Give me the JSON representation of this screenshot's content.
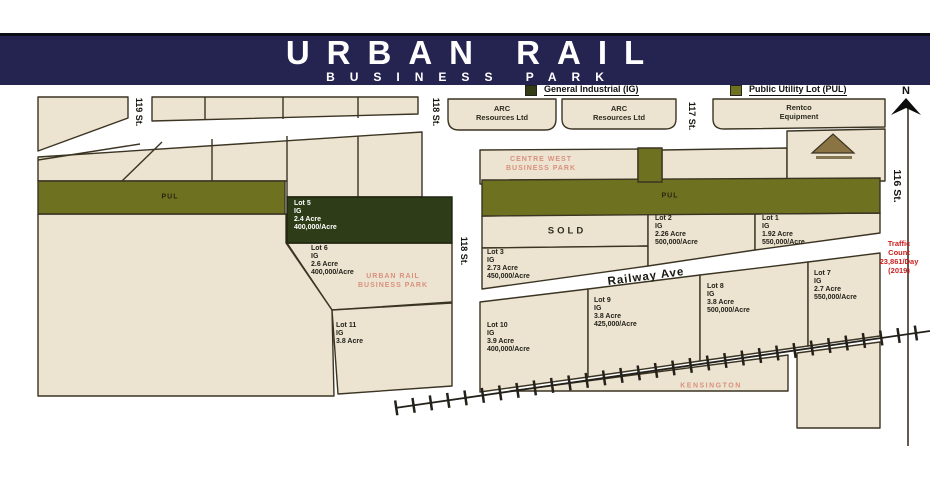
{
  "header": {
    "title": "URBAN RAIL",
    "subtitle": "BUSINESS PARK"
  },
  "legend": {
    "general": {
      "label": "General Industrial (IG)",
      "color": "#323d14"
    },
    "pul": {
      "label": "Public Utility Lot (PUL)",
      "color": "#6e7120"
    }
  },
  "compass": {
    "label": "N"
  },
  "streets": {
    "s119": "119 St.",
    "s118_top": "118 St.",
    "s118_mid": "118 St.",
    "s117": "117 St.",
    "s116": "116 St.",
    "railway": "Railway Ave"
  },
  "labels": {
    "pul_left": "PUL",
    "pul_right": "PUL",
    "sold": "SOLD",
    "centre_west": "CENTRE WEST\nBUSINESS PARK",
    "urban_rail_park": "URBAN RAIL\nBUSINESS PARK",
    "kensington": "KENSINGTON",
    "traffic": "Traffic\nCount\n23,861/Day\n(2019)"
  },
  "businesses": {
    "arc1": "ARC\nResources Ltd",
    "arc2": "ARC\nResources Ltd",
    "rentco": "Rentco\nEquipment"
  },
  "lots": {
    "lot1": {
      "name": "Lot 1",
      "zone": "IG",
      "acre": "1.92 Acre",
      "price": "550,000/Acre"
    },
    "lot2": {
      "name": "Lot 2",
      "zone": "IG",
      "acre": "2.26 Acre",
      "price": "500,000/Acre"
    },
    "lot3": {
      "name": "Lot 3",
      "zone": "IG",
      "acre": "2.73 Acre",
      "price": "450,000/Acre"
    },
    "lot5": {
      "name": "Lot 5",
      "zone": "IG",
      "acre": "2.4 Acre",
      "price": "400,000/Acre"
    },
    "lot6": {
      "name": "Lot 6",
      "zone": "IG",
      "acre": "2.6 Acre",
      "price": "400,000/Acre"
    },
    "lot7": {
      "name": "Lot 7",
      "zone": "IG",
      "acre": "2.7 Acre",
      "price": "550,000/Acre"
    },
    "lot8": {
      "name": "Lot 8",
      "zone": "IG",
      "acre": "3.8 Acre",
      "price": "500,000/Acre"
    },
    "lot9": {
      "name": "Lot 9",
      "zone": "IG",
      "acre": "3.8 Acre",
      "price": "425,000/Acre"
    },
    "lot10": {
      "name": "Lot 10",
      "zone": "IG",
      "acre": "3.9 Acre",
      "price": "400,000/Acre"
    },
    "lot11": {
      "name": "Lot 11",
      "zone": "IG",
      "acre": "3.8 Acre"
    }
  },
  "colors": {
    "navy": "#252350",
    "beige": "#ece4d0",
    "olive": "#6e7120",
    "dark_green": "#2e3d17",
    "salmon": "#d9907e",
    "traffic_red": "#cc1f1f"
  }
}
